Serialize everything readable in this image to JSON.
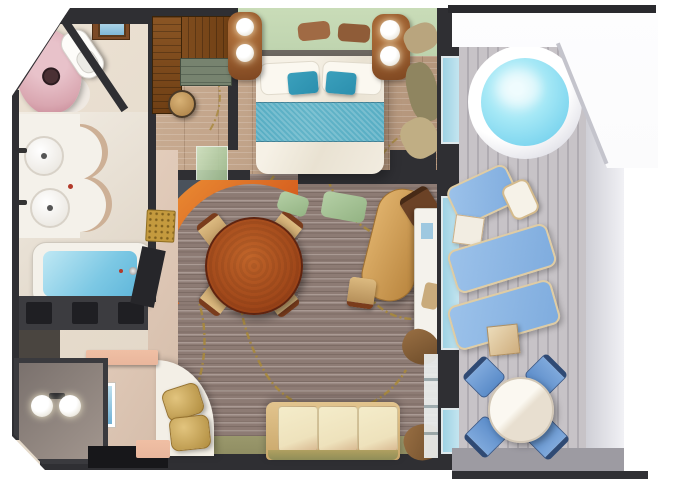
{
  "meta": {
    "kind": "3d-floor-plan-rendering",
    "subject": "cruise-ship-suite-with-private-balcony",
    "canvas": {
      "width": 680,
      "height": 486
    }
  },
  "rooms": {
    "shower_wc": "Shower & WC",
    "bathroom": "Bathroom",
    "closet": "Walk-in Closet",
    "bedroom": "Bedroom",
    "living_dining": "Living & Dining Room",
    "entry": "Entry Hall",
    "vestibule": "Entry Vestibule",
    "balcony": "Private Balcony"
  },
  "furniture": {
    "shower_wc": [
      "mosaic-shower",
      "toilet",
      "wall-cabinet-with-picture"
    ],
    "bathroom": [
      "double-sink-vanity",
      "bathtub-with-water",
      "towel-shelves"
    ],
    "closet": [
      "l-shaped-wardrobe",
      "drawer-cabinet",
      "stool",
      "sliding-glass-door"
    ],
    "bedroom": [
      "double-bed",
      "white-pillows",
      "teal-accent-pillows",
      "teal-bed-runner",
      "nightstand-left",
      "nightstand-right",
      "globe-table-lamps",
      "headboard",
      "shelf-cushions",
      "window-curtains"
    ],
    "living_dining": [
      "round-dining-table",
      "four-dining-chairs",
      "curved-feature-wall",
      "red-accent-arch",
      "oval-table",
      "desk",
      "dark-chair",
      "mint-chairs",
      "sofa",
      "curved-bench",
      "gold-cushions",
      "gold-ottoman",
      "open-door",
      "console-tables",
      "picture-frame",
      "wall-lamps",
      "entry-mat"
    ],
    "balcony": [
      "hot-tub",
      "sun-lounger-1",
      "sun-lounger-2",
      "sun-lounger-3",
      "lounger-pillow",
      "side-table-white",
      "side-table-wood",
      "round-balcony-table",
      "four-balcony-chairs",
      "glass-railing",
      "deck-awning"
    ]
  },
  "palette": {
    "wall": "#2f2f33",
    "carpet": "#8d7b74",
    "wood": "#bfa289",
    "deck": "#bcb8be",
    "mint": "#bed3ae",
    "teal": "#2b8fae",
    "runner": "#62b4c8",
    "hotTub": "#7fd6ef",
    "lounger": "#7facde",
    "chairBlue": "#5b8cc9",
    "arcRed": "#c73f10",
    "arcOrange": "#ef9638",
    "dining": "#9c4418",
    "sofa": "#eee2bc",
    "gold": "#b08c3e",
    "showerPink": "#d9a6b0",
    "tubWater": "#7cc8e4",
    "vine": "#a8893c",
    "hall": "#ddc7b6",
    "olive": "#8f8d62",
    "salmon": "#e9b69c",
    "glass": "#9ed2e4",
    "curtain": "#6b4a28",
    "awning": "#f7f7f9"
  }
}
